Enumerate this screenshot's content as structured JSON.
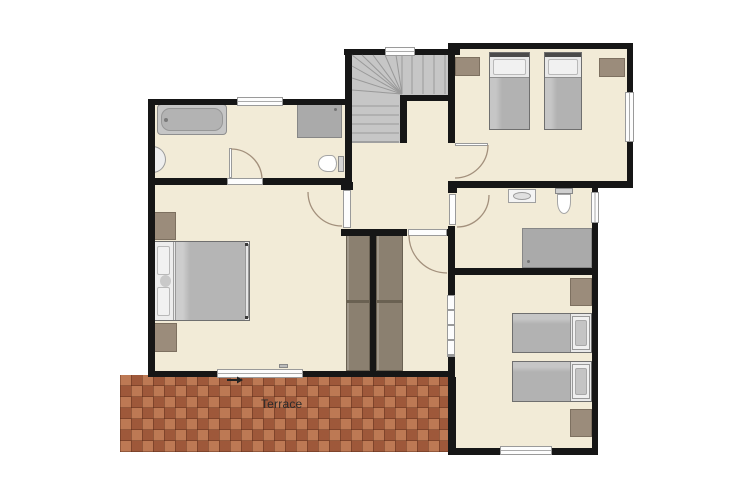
{
  "labels": {
    "terrace": "Terrace"
  },
  "colors": {
    "floor": "#f2ebd7",
    "wall": "#161616",
    "stairs": "#c6c6c6",
    "shower": "#aaaaaa",
    "furniture_wood": "#9b8c7b",
    "wardrobe": "#8b8070",
    "terrace_brick": "#b06a48",
    "bed_blanket": "#b5b5b5",
    "door_arc": "#a3907c"
  },
  "icons": [
    "bathtub-icon",
    "wall-sink-icon",
    "vanity-sink-icon",
    "toilet-icon",
    "shower-mat-icon",
    "double-bed-icon",
    "single-bed-icon",
    "nightstand-icon",
    "wardrobe-icon",
    "staircase-icon",
    "door-swing-icon",
    "window-icon",
    "radiator-icon",
    "entry-arrow-icon"
  ]
}
